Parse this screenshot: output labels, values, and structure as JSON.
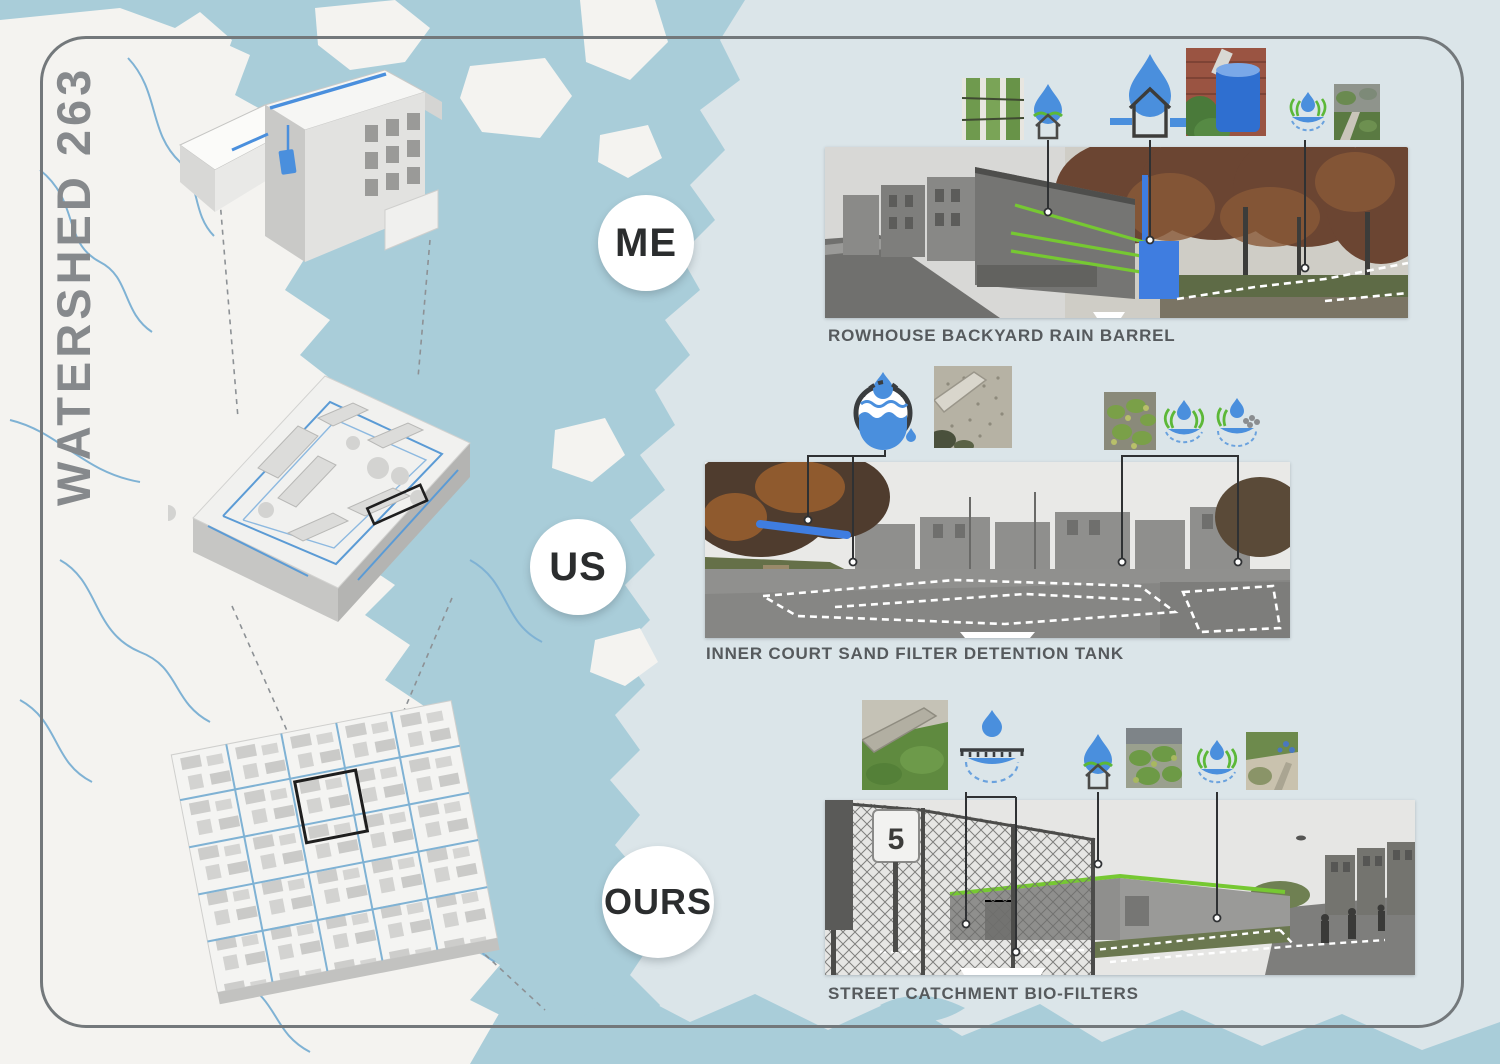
{
  "poster": {
    "title": "WATERSHED 263",
    "scale_markers": [
      {
        "label": "ME"
      },
      {
        "label": "US"
      },
      {
        "label": "OURS"
      }
    ],
    "panels": [
      {
        "caption": "ROWHOUSE BACKYARD RAIN BARREL",
        "icons": [
          "yard-strips-photo",
          "rain-drop-house-icon",
          "rain-drop-downspout-house-icon",
          "rain-barrel-photo",
          "bio-filter-icon",
          "backyard-garden-photo"
        ]
      },
      {
        "caption": "INNER COURT SAND FILTER DETENTION TANK",
        "icons": [
          "detention-tank-icon",
          "sand-filter-photo",
          "planting-photo",
          "bio-swale-icon",
          "bio-filter-icon"
        ]
      },
      {
        "caption": "STREET CATCHMENT BIO-FILTERS",
        "sign_text": "5",
        "icons": [
          "green-roof-photo",
          "catchment-basin-icon",
          "rain-drop-house-icon",
          "bio-filter-planting-photo",
          "bio-swale-icon",
          "streetscape-photo"
        ]
      }
    ],
    "map": {
      "drawings": [
        "rowhouse-axonometric",
        "city-block-axonometric",
        "neighborhood-grid-axonometric"
      ]
    },
    "colors": {
      "water": "#a9cdd9",
      "land": "#f4f3f0",
      "panel_background": "#dbe5e9",
      "river": "#7fb2d4",
      "annotation_blue": "#3f7de0",
      "annotation_green": "#76c832",
      "title_gray": "#86898c",
      "caption_gray": "#565a5d",
      "frame_gray": "#73787b"
    }
  }
}
